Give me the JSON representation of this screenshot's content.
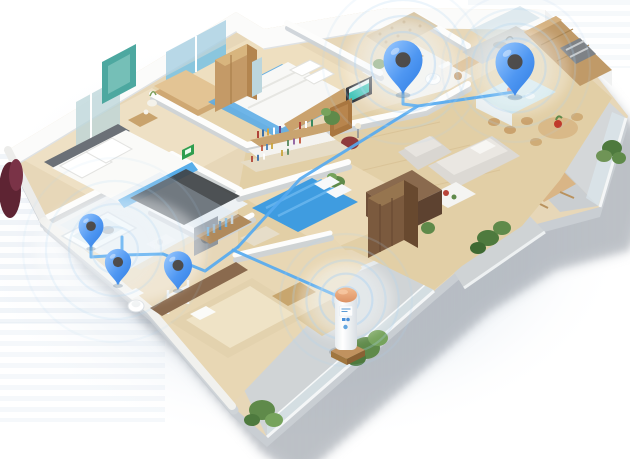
{
  "scene": {
    "type": "isometric-floorplan-illustration",
    "description": "3D cutaway floor plan of an apartment; five blue location pins with signal rings are connected by light-blue lines to a white cylindrical smart hub with an orange top standing on the balcony",
    "width": 630,
    "height": 459
  },
  "colors": {
    "pin_top": "#9ecbff",
    "pin_bottom": "#2e7ce2",
    "pin_hole": "#4d4338",
    "line_blue": "#56aaf0",
    "ring_blue": "#aed3f2",
    "glow_white": "#eef6fc",
    "device_top": "#eba87c",
    "shadow": "#9aa2ac",
    "wood_light": "#e9d9b8",
    "wall_white": "#fbfbfa",
    "plant_green": "#6f9456"
  },
  "rooms": [
    {
      "id": "bedroom-1"
    },
    {
      "id": "closet-corridor"
    },
    {
      "id": "bedroom-2"
    },
    {
      "id": "wc"
    },
    {
      "id": "kitchen"
    },
    {
      "id": "living-room"
    },
    {
      "id": "bedroom-3"
    },
    {
      "id": "bathroom"
    },
    {
      "id": "walk-in-closet"
    },
    {
      "id": "bedroom-4"
    },
    {
      "id": "balcony-right"
    },
    {
      "id": "balcony-long"
    }
  ],
  "network": {
    "pins": [
      {
        "id": "pin-bathroom-a",
        "x": 91,
        "y": 248,
        "scale": 0.78
      },
      {
        "id": "pin-bathroom-b",
        "x": 118,
        "y": 285,
        "scale": 0.82
      },
      {
        "id": "pin-closet",
        "x": 178,
        "y": 290,
        "scale": 0.88
      },
      {
        "id": "pin-wc",
        "x": 403,
        "y": 94,
        "scale": 1.22
      },
      {
        "id": "pin-kitchen",
        "x": 515,
        "y": 96,
        "scale": 1.22
      }
    ],
    "lines": [
      "91,244 91,257 122,255",
      "122,237 122,255 163,254 205,271 238,247",
      "118,283 118,257",
      "238,247 300,179 418,106 514,92",
      "403,92 403,104 418,106",
      "233,250 344,299"
    ],
    "ring_sets": [
      {
        "id": "rings-bathroom",
        "x": 115,
        "y": 250,
        "max": 92,
        "count": 4,
        "strength": 0.3
      },
      {
        "id": "rings-wc",
        "x": 403,
        "y": 64,
        "max": 80,
        "count": 5,
        "strength": 0.5
      },
      {
        "id": "rings-kitchen",
        "x": 516,
        "y": 68,
        "max": 74,
        "count": 5,
        "strength": 0.46
      },
      {
        "id": "rings-device",
        "x": 346,
        "y": 300,
        "max": 66,
        "count": 5,
        "strength": 0.55
      }
    ]
  },
  "device": {
    "id": "smart-hub",
    "x": 346,
    "y": 348
  }
}
